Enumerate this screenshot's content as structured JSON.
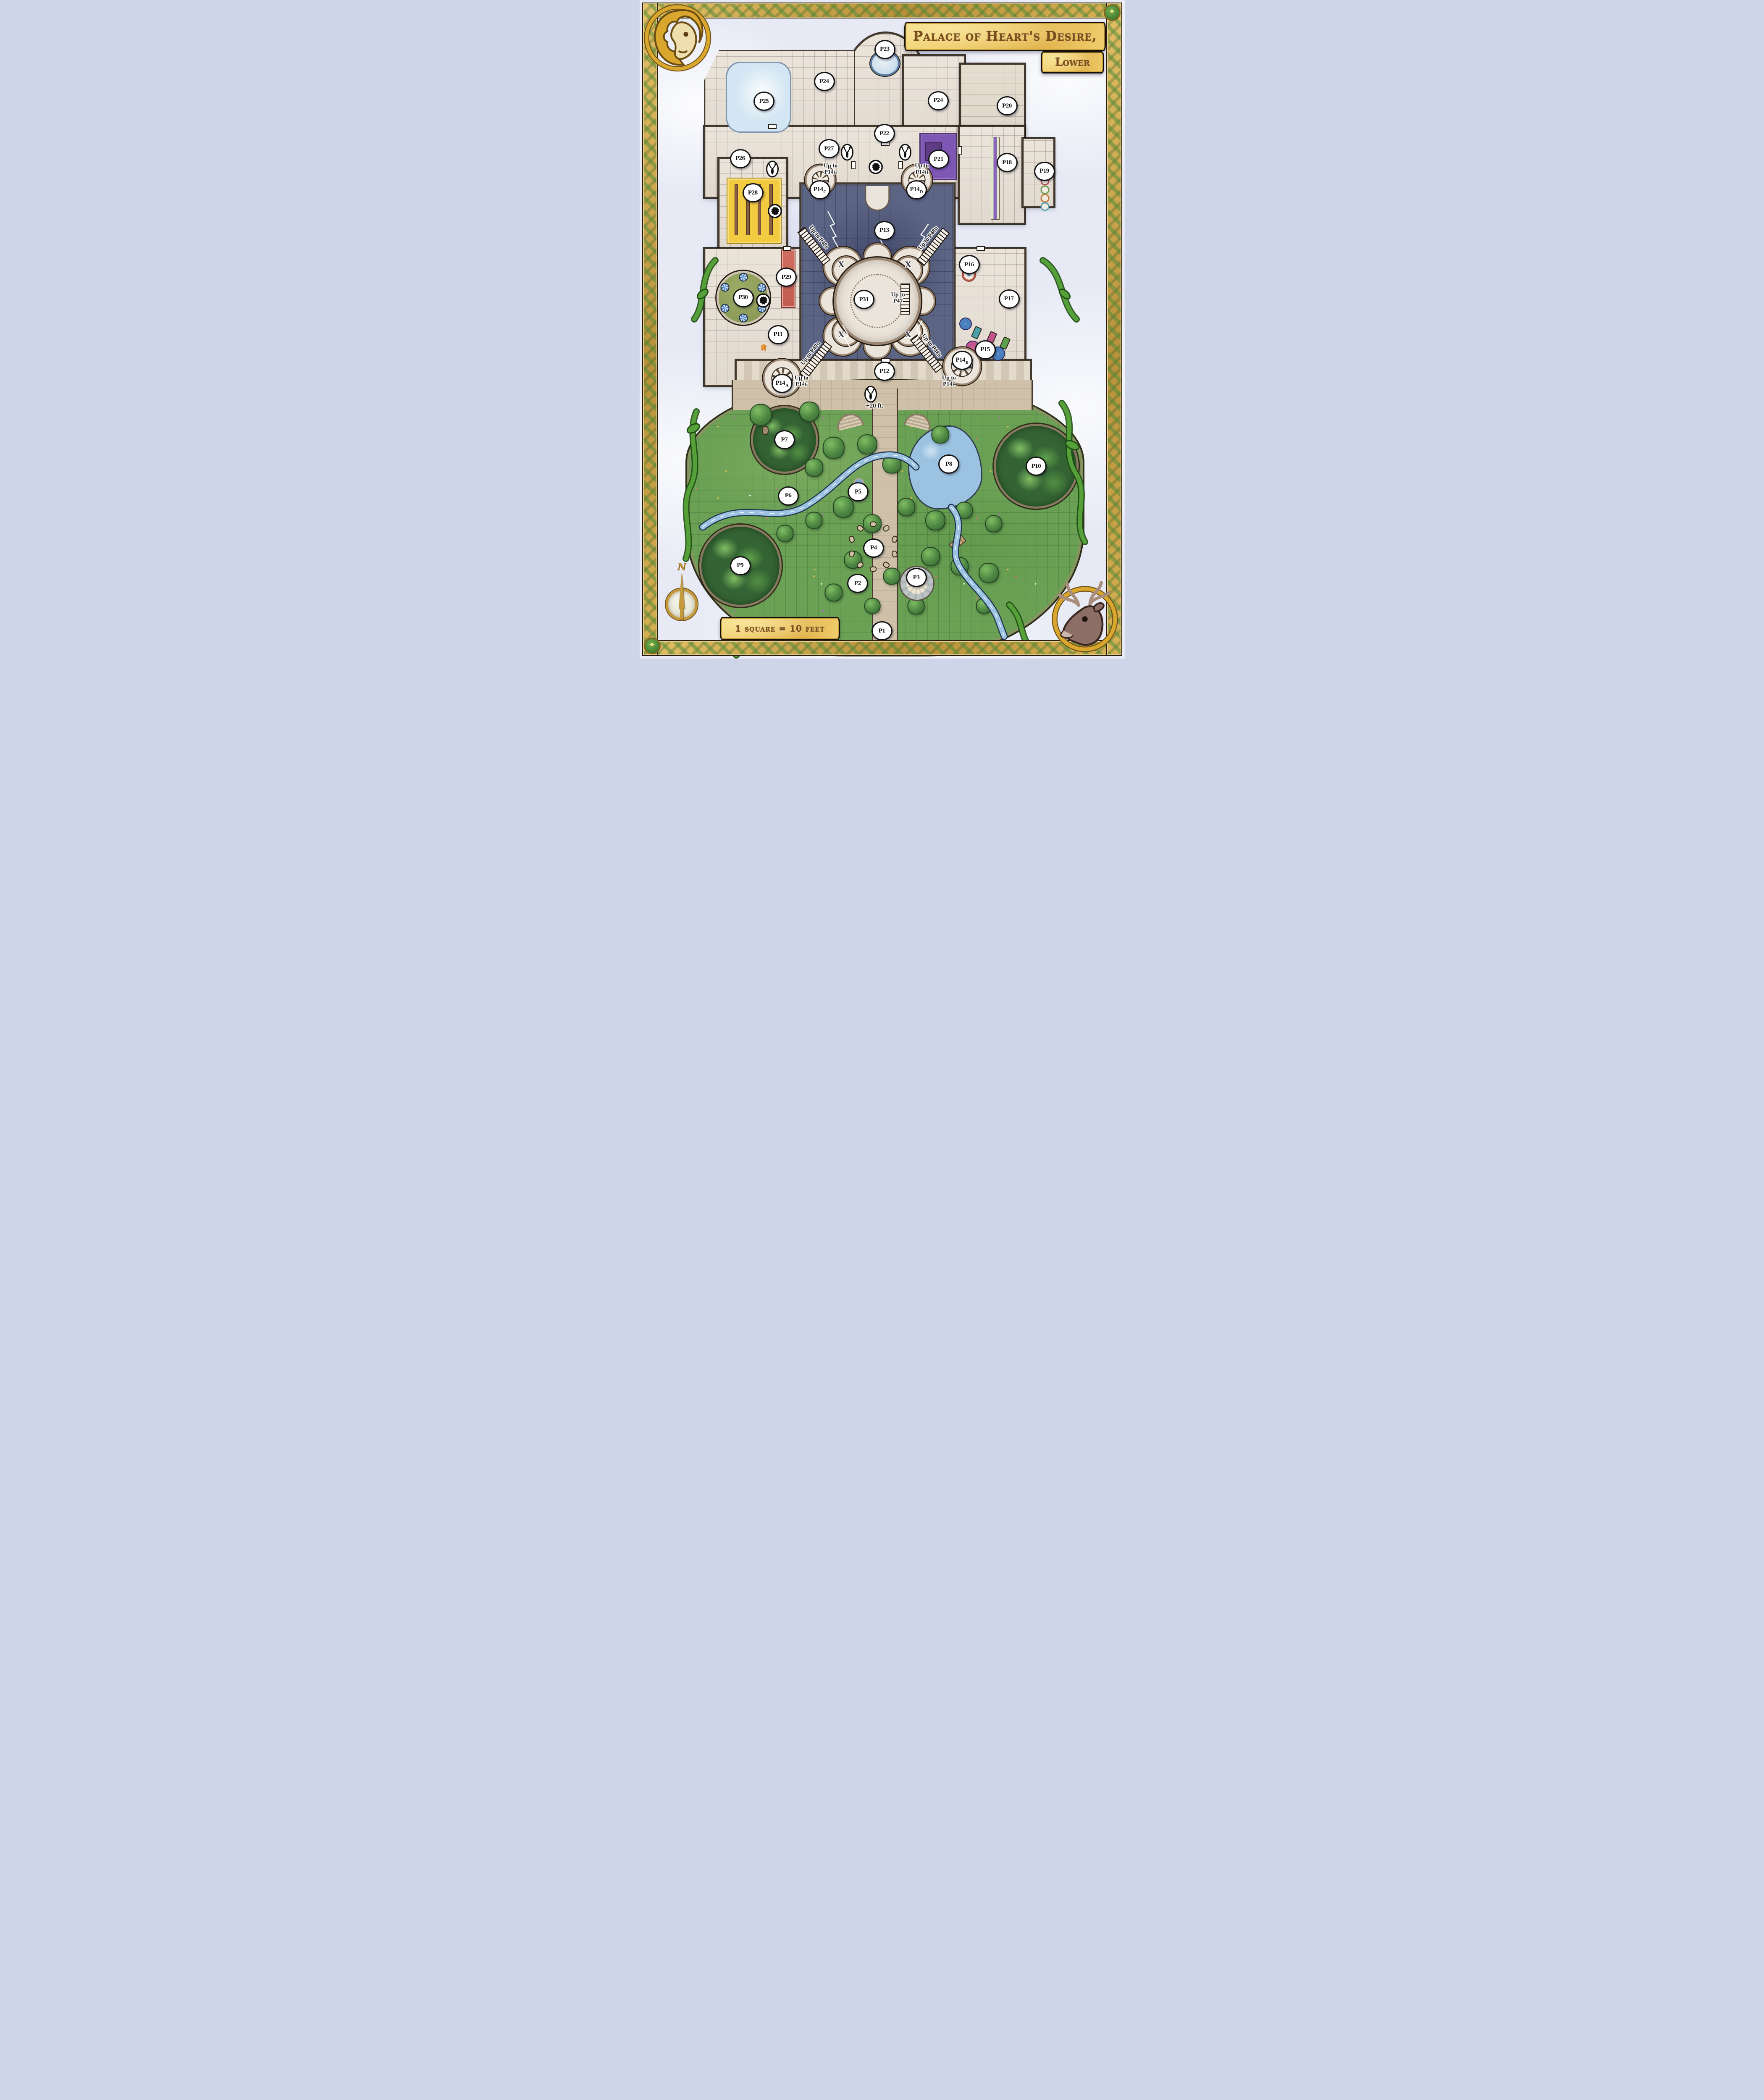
{
  "banners": {
    "title": "Palace of Heart's Desire,",
    "subtitle": "Lower",
    "scale": "1 square = 10 feet"
  },
  "compass": {
    "north": "N"
  },
  "icons": {
    "star": "✦"
  },
  "x_mark_glyph": "X",
  "elevation_note": {
    "text": "+20 ft.",
    "x": 48.5,
    "y": 61.7
  },
  "colors": {
    "cloud": "#e7eaf5",
    "outline": "#241c12",
    "frame_gold": "#c79b3b",
    "frame_green": "#4c8b39",
    "banner_fill": "#f3d475",
    "banner_text": "#7c4d1c",
    "marble": "#ebe4da",
    "marble_line": "#a89c90",
    "wall": "#9b8672",
    "storm": "#5d6585",
    "storm_dark": "#3d4463",
    "lightning": "#ffffff",
    "terrace": "#dcd2c2",
    "garden": "#6ba155",
    "tree_dark": "#356434",
    "tree_light": "#7fbd63",
    "water": "#9cc2e1",
    "path": "#cfc1a9",
    "vine": "#55a038",
    "lawn": "#8c9c58",
    "carpet_yellow": "#f2cb40",
    "rug_purple": "#7e57b5",
    "runner_red": "#cf6e60",
    "label_bg": "#ffffff",
    "label_ink": "#141414"
  },
  "room_labels": [
    {
      "main": "P1",
      "sub": "",
      "x": 50.0,
      "y": 95.8
    },
    {
      "main": "P2",
      "sub": "",
      "x": 45.0,
      "y": 88.6
    },
    {
      "main": "P3",
      "sub": "",
      "x": 57.1,
      "y": 87.7
    },
    {
      "main": "P4",
      "sub": "",
      "x": 48.3,
      "y": 83.2
    },
    {
      "main": "P5",
      "sub": "",
      "x": 45.1,
      "y": 74.7
    },
    {
      "main": "P6",
      "sub": "",
      "x": 30.7,
      "y": 75.3
    },
    {
      "main": "P7",
      "sub": "",
      "x": 29.9,
      "y": 66.8
    },
    {
      "main": "P8",
      "sub": "",
      "x": 63.8,
      "y": 70.5
    },
    {
      "main": "P9",
      "sub": "",
      "x": 20.8,
      "y": 85.9
    },
    {
      "main": "P10",
      "sub": "",
      "x": 81.8,
      "y": 70.8
    },
    {
      "main": "P11",
      "sub": "",
      "x": 28.6,
      "y": 50.8
    },
    {
      "main": "P12",
      "sub": "",
      "x": 50.5,
      "y": 56.4
    },
    {
      "main": "P13",
      "sub": "",
      "x": 50.5,
      "y": 35.0
    },
    {
      "main": "P14",
      "sub": "A",
      "x": 29.4,
      "y": 58.2
    },
    {
      "main": "P14",
      "sub": "B",
      "x": 66.5,
      "y": 54.7
    },
    {
      "main": "P14",
      "sub": "C",
      "x": 37.2,
      "y": 28.8
    },
    {
      "main": "P14",
      "sub": "D",
      "x": 57.1,
      "y": 28.8
    },
    {
      "main": "P15",
      "sub": "",
      "x": 71.3,
      "y": 53.1
    },
    {
      "main": "P16",
      "sub": "",
      "x": 68.0,
      "y": 40.2
    },
    {
      "main": "P17",
      "sub": "",
      "x": 76.2,
      "y": 45.4
    },
    {
      "main": "P18",
      "sub": "",
      "x": 75.8,
      "y": 24.7
    },
    {
      "main": "P19",
      "sub": "",
      "x": 83.5,
      "y": 26.0
    },
    {
      "main": "P20",
      "sub": "",
      "x": 75.8,
      "y": 16.1
    },
    {
      "main": "P21",
      "sub": "",
      "x": 61.7,
      "y": 24.2
    },
    {
      "main": "P22",
      "sub": "",
      "x": 50.5,
      "y": 20.3
    },
    {
      "main": "P23",
      "sub": "",
      "x": 50.6,
      "y": 7.5
    },
    {
      "main": "P24",
      "sub": "",
      "x": 38.1,
      "y": 12.4
    },
    {
      "main": "P24",
      "sub": "",
      "x": 61.6,
      "y": 15.3
    },
    {
      "main": "P25",
      "sub": "",
      "x": 25.7,
      "y": 15.4
    },
    {
      "main": "P26",
      "sub": "",
      "x": 20.8,
      "y": 24.1
    },
    {
      "main": "P27",
      "sub": "",
      "x": 39.1,
      "y": 22.6
    },
    {
      "main": "P28",
      "sub": "",
      "x": 23.4,
      "y": 29.3
    },
    {
      "main": "P29",
      "sub": "",
      "x": 30.3,
      "y": 42.1
    },
    {
      "main": "P30",
      "sub": "",
      "x": 21.4,
      "y": 45.2
    },
    {
      "main": "P31",
      "sub": "",
      "x": 46.3,
      "y": 45.5
    }
  ],
  "stair_labels": [
    {
      "pre": "Up to",
      "main": "P14",
      "sub": "G",
      "x": 39.4,
      "y": 25.7,
      "rot": 0
    },
    {
      "pre": "Up to",
      "main": "P14",
      "sub": "H",
      "x": 58.2,
      "y": 25.7,
      "rot": 0
    },
    {
      "pre": "Up to",
      "main": "P47",
      "sub": "",
      "x": 53.3,
      "y": 45.3,
      "rot": 0
    },
    {
      "pre": "Up to",
      "main": "P14",
      "sub": "E",
      "x": 33.4,
      "y": 57.9,
      "rot": 0
    },
    {
      "pre": "Up to",
      "main": "P14",
      "sub": "F",
      "x": 63.8,
      "y": 57.9,
      "rot": 0
    },
    {
      "pre": "Up to",
      "main": "P48",
      "sub": "E",
      "x": 36.9,
      "y": 36.1,
      "rot": 52
    },
    {
      "pre": "Up to",
      "main": "P48",
      "sub": "D",
      "x": 59.6,
      "y": 36.2,
      "rot": -52
    },
    {
      "pre": "Up to",
      "main": "P48",
      "sub": "G",
      "x": 35.4,
      "y": 53.7,
      "rot": -52
    },
    {
      "pre": "Up to",
      "main": "P48",
      "sub": "B",
      "x": 60.1,
      "y": 52.5,
      "rot": 52
    }
  ],
  "x_marks": [
    {
      "x": 41.6,
      "y": 40.2
    },
    {
      "x": 55.4,
      "y": 40.2
    },
    {
      "x": 41.6,
      "y": 50.8
    },
    {
      "x": 55.4,
      "y": 50.8
    }
  ],
  "markers": {
    "stag": [
      {
        "x": 42.8,
        "y": 23.3
      },
      {
        "x": 54.8,
        "y": 23.3
      },
      {
        "x": 27.4,
        "y": 25.8
      },
      {
        "x": 47.7,
        "y": 60.0
      }
    ],
    "lion": [
      {
        "x": 48.7,
        "y": 25.5
      },
      {
        "x": 27.9,
        "y": 32.2
      },
      {
        "x": 25.5,
        "y": 45.8
      }
    ]
  }
}
